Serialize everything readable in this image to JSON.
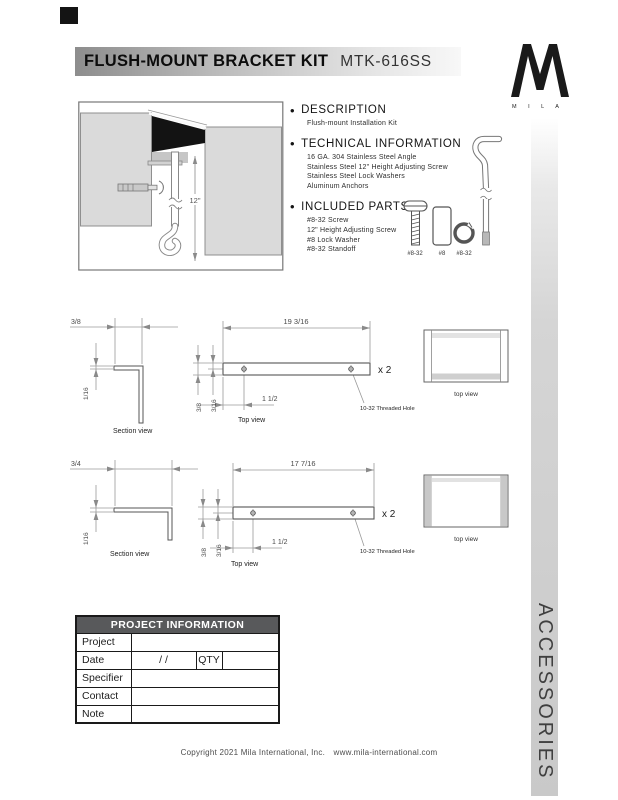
{
  "header": {
    "title": "FLUSH-MOUNT BRACKET KIT",
    "model": "MTK-616SS"
  },
  "logo": {
    "word": "M I L A"
  },
  "side_bar": {
    "label": "ACCESSORIES"
  },
  "sections": [
    {
      "heading": "DESCRIPTION",
      "lines": [
        "Flush-mount Installation Kit"
      ]
    },
    {
      "heading": "TECHNICAL INFORMATION",
      "lines": [
        "16 GA. 304 Stainless Steel Angle",
        "Stainless Steel 12\" Height Adjusting Screw",
        "Stainless Steel Lock Washers",
        "Aluminum Anchors"
      ]
    },
    {
      "heading": "INCLUDED PARTS",
      "lines": [
        "#8-32 Screw",
        "12\" Height Adjusting Screw",
        "#8 Lock Washer",
        "#8-32 Standoff"
      ]
    }
  ],
  "parts": {
    "labels": [
      "#8-32",
      "#8",
      "#8-32"
    ]
  },
  "install_drawing": {
    "height_dim": "12\""
  },
  "drawings": [
    {
      "section_width": "3/8",
      "section_thickness": "1/16",
      "section_label": "Section view",
      "length": "19  3/16",
      "hole_offset": "1 1/2",
      "bar_width": "3/8",
      "hole_inset": "3/16",
      "qty": "x 2",
      "hole_note": "10-32 Threaded Hole",
      "top_label": "Top view",
      "box_label": "top view"
    },
    {
      "section_width": "3/4",
      "section_thickness": "1/16",
      "section_label": "Section view",
      "length": "17  7/16",
      "hole_offset": "1 1/2",
      "bar_width": "3/8",
      "hole_inset": "3/16",
      "qty": "x 2",
      "hole_note": "10-32 Threaded Hole",
      "top_label": "Top view",
      "box_label": "top view"
    }
  ],
  "project_table": {
    "header": "PROJECT INFORMATION",
    "rows": [
      "Project",
      "Date",
      "Specifier",
      "Contact",
      "Note"
    ],
    "date_value": "/      /",
    "qty_label": "QTY"
  },
  "footer": {
    "copyright": "Copyright 2021 Mila International, Inc.",
    "url": "www.mila-international.com"
  }
}
